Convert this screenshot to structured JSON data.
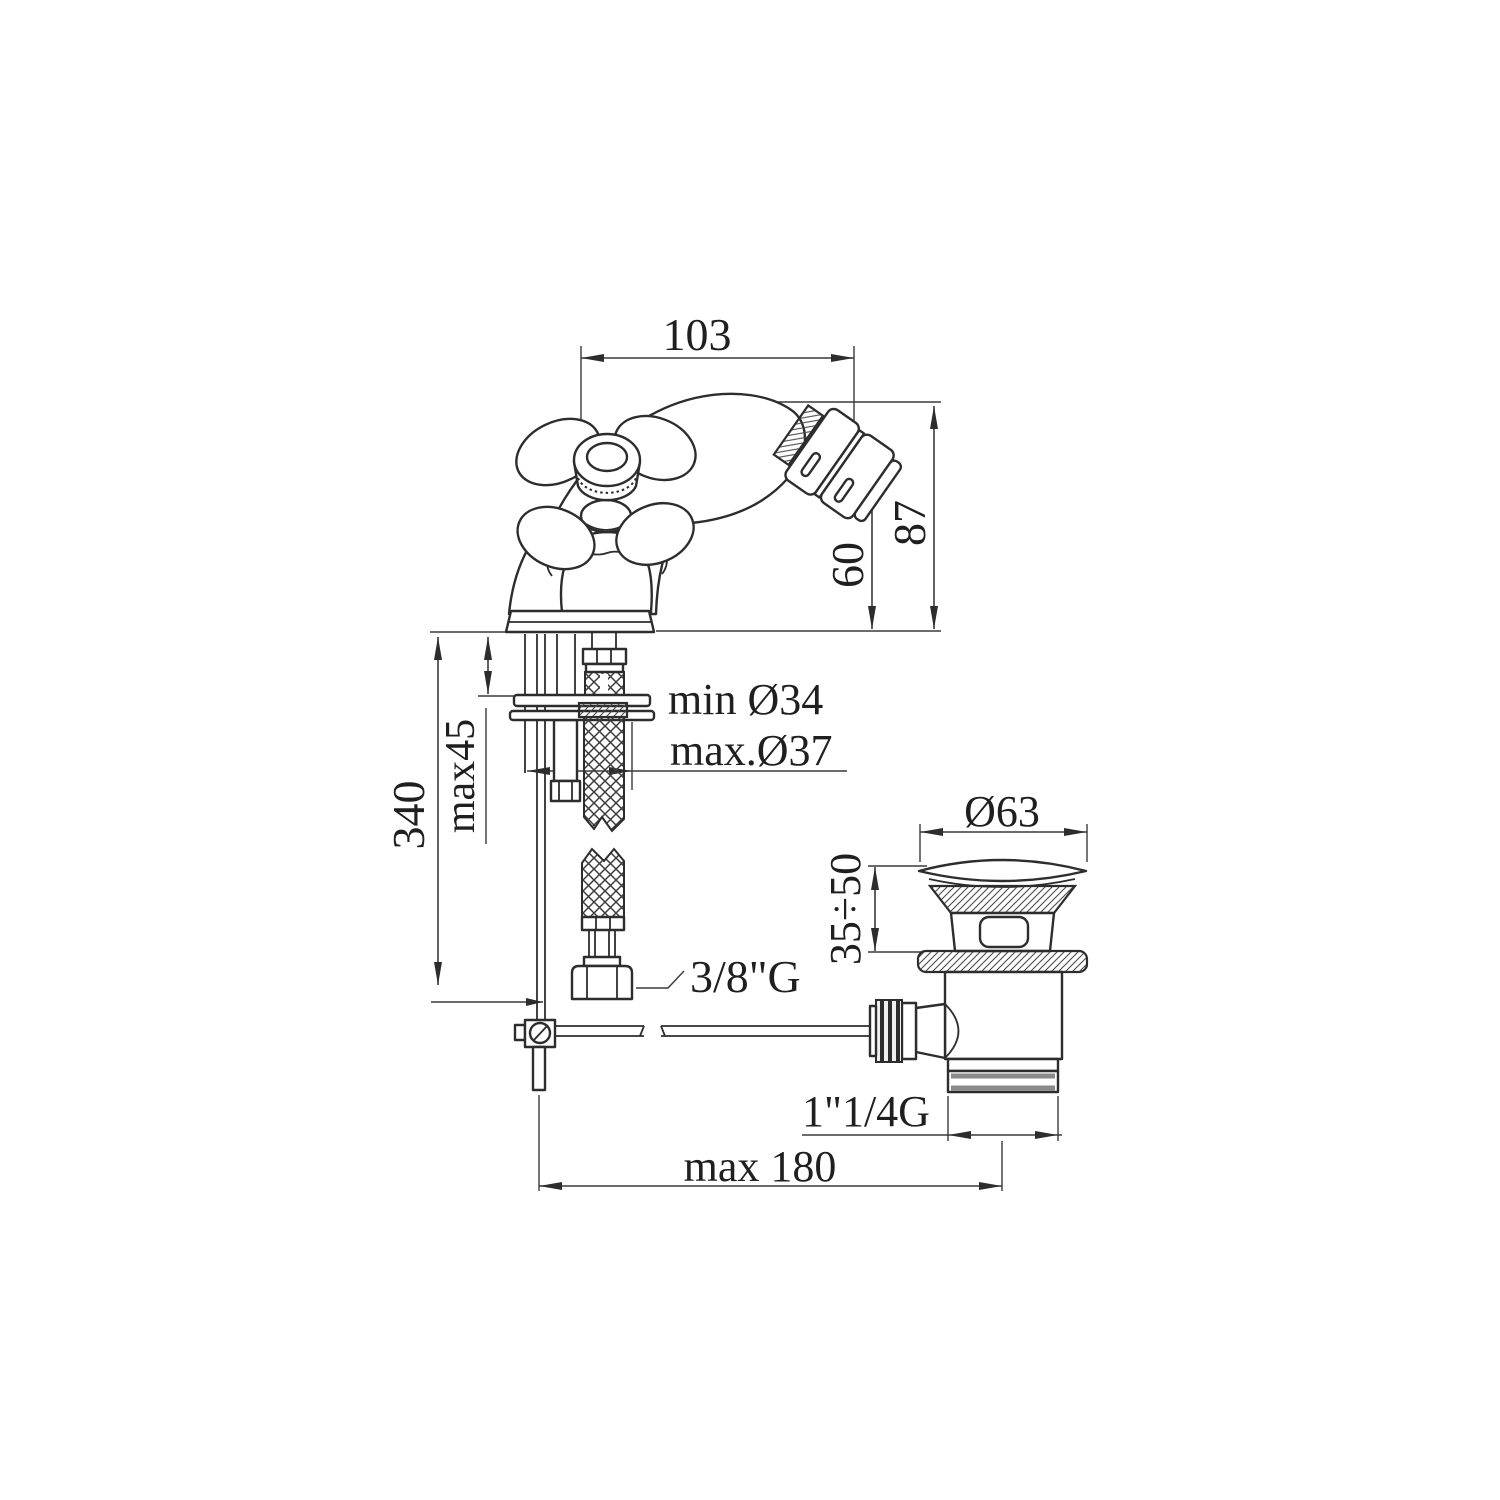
{
  "drawing": {
    "type": "technical-dimension-diagram",
    "subject": "bidet single-hole mixer with flexible supply hoses and pop-up waste",
    "background_color": "#ffffff",
    "line_color": "#2d2d2d",
    "dimensions": {
      "spout_projection": "103",
      "spout_height": "87",
      "outlet_height": "60",
      "supply_hose_length": "340",
      "max_deck_thickness": "max45",
      "hole_min_diameter": "min Ø34",
      "hole_max_diameter": "max.Ø37",
      "supply_thread": "3/8\"G",
      "waste_flange_diameter": "Ø63",
      "waste_height_range": "35÷50",
      "waste_thread": "1\"1/4G",
      "rod_max_reach": "max 180"
    }
  }
}
